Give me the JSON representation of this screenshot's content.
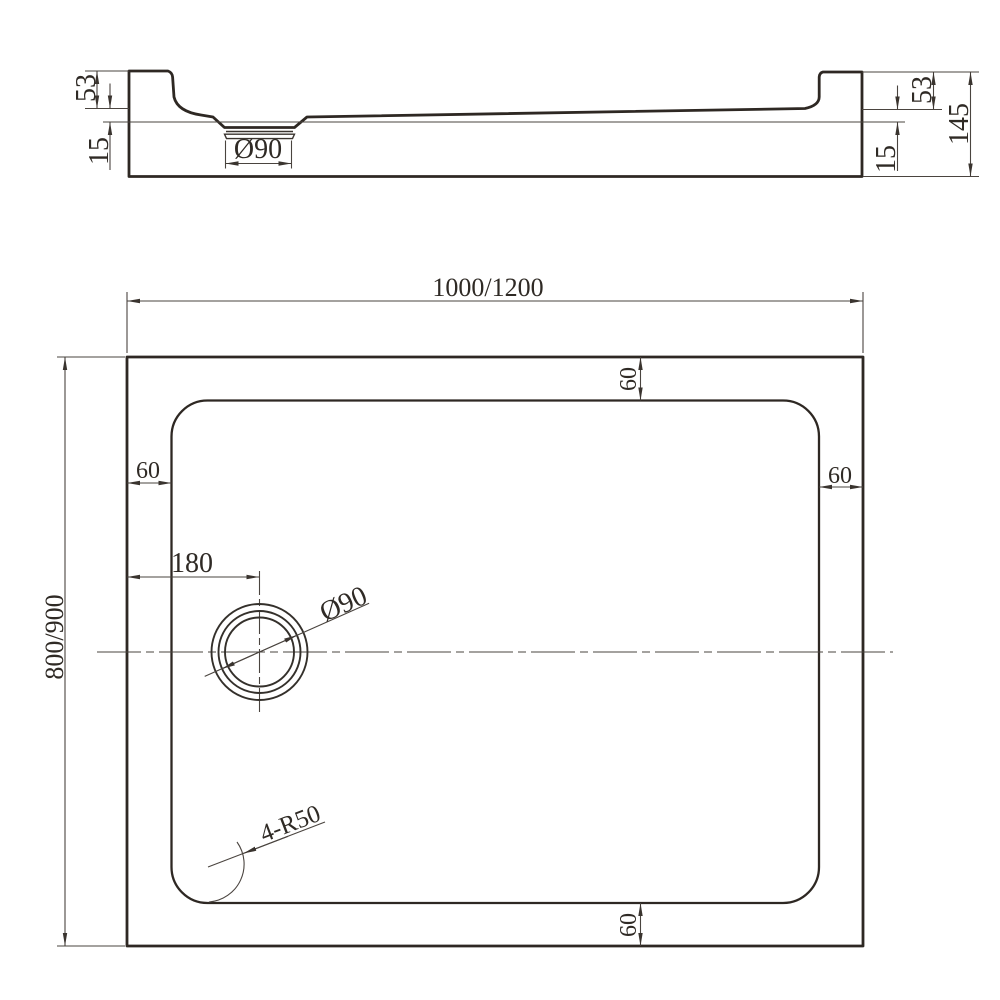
{
  "section_view": {
    "lip_height_left": "53",
    "base_inset_left": "15",
    "drain_diameter": "Ø90",
    "lip_height_right": "53",
    "base_inset_right": "15",
    "overall_height": "145"
  },
  "plan_view": {
    "overall_width": "1000/1200",
    "overall_depth": "800/900",
    "rim_width_top": "60",
    "rim_width_left": "60",
    "rim_width_right": "60",
    "rim_width_bottom": "60",
    "drain_center_offset": "180",
    "drain_diameter": "Ø90",
    "corner_radius": "4-R50"
  },
  "colors": {
    "outline": "#2e2823",
    "dimension_lines": "#4a443f",
    "text": "#2f2a25",
    "background": "#ffffff"
  }
}
